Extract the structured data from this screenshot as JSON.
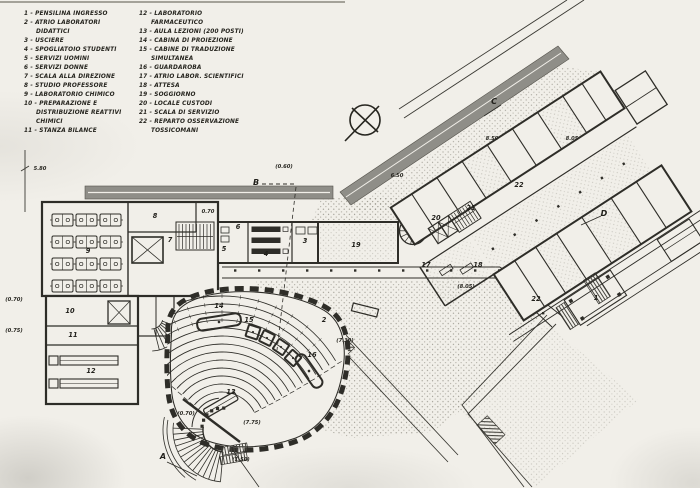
{
  "legend": {
    "col1": [
      {
        "num": "1",
        "label": "Pensilina ingresso"
      },
      {
        "num": "2",
        "label": "Atrio laboratori didattici"
      },
      {
        "num": "3",
        "label": "Usciere"
      },
      {
        "num": "4",
        "label": "Spogliatoio studenti"
      },
      {
        "num": "5",
        "label": "Servizi uomini"
      },
      {
        "num": "6",
        "label": "Servizi donne"
      },
      {
        "num": "7",
        "label": "Scala alla direzione"
      },
      {
        "num": "8",
        "label": "Studio professore"
      },
      {
        "num": "9",
        "label": "Laboratorio chimico"
      },
      {
        "num": "10",
        "label": "Preparazione e distribuzione reattivi chimici"
      },
      {
        "num": "11",
        "label": "Stanza bilance"
      }
    ],
    "col2": [
      {
        "num": "12",
        "label": "Laboratorio farmaceutico"
      },
      {
        "num": "13",
        "label": "Aula lezioni (200 posti)"
      },
      {
        "num": "14",
        "label": "Cabina di proiezione"
      },
      {
        "num": "15",
        "label": "Cabine di traduzione simultanea"
      },
      {
        "num": "16",
        "label": "Guardaroba"
      },
      {
        "num": "17",
        "label": "Atrio labor. scientifici"
      },
      {
        "num": "18",
        "label": "Attesa"
      },
      {
        "num": "19",
        "label": "Soggiorno"
      },
      {
        "num": "20",
        "label": "Locale custodi"
      },
      {
        "num": "21",
        "label": "Scala di servizio"
      },
      {
        "num": "22",
        "label": "Reparto osservazione tossicomani"
      }
    ]
  },
  "plan": {
    "room_labels": [
      {
        "id": "1",
        "x": 596,
        "y": 300
      },
      {
        "id": "2",
        "x": 324,
        "y": 322
      },
      {
        "id": "3",
        "x": 305,
        "y": 243
      },
      {
        "id": "4",
        "x": 266,
        "y": 256
      },
      {
        "id": "5",
        "x": 224,
        "y": 251
      },
      {
        "id": "6",
        "x": 238,
        "y": 229
      },
      {
        "id": "7",
        "x": 170,
        "y": 242
      },
      {
        "id": "8",
        "x": 155,
        "y": 218
      },
      {
        "id": "9",
        "x": 88,
        "y": 253
      },
      {
        "id": "10",
        "x": 70,
        "y": 313
      },
      {
        "id": "11",
        "x": 73,
        "y": 337
      },
      {
        "id": "12",
        "x": 91,
        "y": 373
      },
      {
        "id": "13",
        "x": 231,
        "y": 394
      },
      {
        "id": "14",
        "x": 219,
        "y": 308
      },
      {
        "id": "15",
        "x": 249,
        "y": 322
      },
      {
        "id": "16",
        "x": 312,
        "y": 357
      },
      {
        "id": "17",
        "x": 426,
        "y": 267
      },
      {
        "id": "18",
        "x": 478,
        "y": 267
      },
      {
        "id": "19",
        "x": 356,
        "y": 247
      },
      {
        "id": "20",
        "x": 436,
        "y": 220
      },
      {
        "id": "21",
        "x": 471,
        "y": 210
      },
      {
        "id": "22",
        "x": 536,
        "y": 301
      },
      {
        "id": "22",
        "x": 519,
        "y": 187
      }
    ],
    "dimensions": [
      {
        "text": "5.80",
        "x": 40,
        "y": 170
      },
      {
        "text": "0.70",
        "x": 208,
        "y": 213
      },
      {
        "text": "(0.70)",
        "x": 14,
        "y": 301
      },
      {
        "text": "(0.75)",
        "x": 14,
        "y": 332
      },
      {
        "text": "(0.70)",
        "x": 186,
        "y": 415
      },
      {
        "text": "(7.75)",
        "x": 252,
        "y": 424
      },
      {
        "text": "(1.50)",
        "x": 241,
        "y": 461
      },
      {
        "text": "(7.30)",
        "x": 345,
        "y": 342
      },
      {
        "text": "(0.60)",
        "x": 284,
        "y": 168
      },
      {
        "text": "6.50",
        "x": 397,
        "y": 177
      },
      {
        "text": "8.50",
        "x": 492,
        "y": 140
      },
      {
        "text": "8.05",
        "x": 572,
        "y": 140
      },
      {
        "text": "(8.05)",
        "x": 466,
        "y": 288
      }
    ],
    "sections": [
      {
        "id": "A",
        "x": 163,
        "y": 459
      },
      {
        "id": "B",
        "x": 256,
        "y": 185
      },
      {
        "id": "C",
        "x": 494,
        "y": 104
      },
      {
        "id": "D",
        "x": 604,
        "y": 216
      }
    ],
    "colors": {
      "ink": "#2e2d28",
      "paper": "#f1efe9",
      "band": "#8f8e88"
    }
  }
}
